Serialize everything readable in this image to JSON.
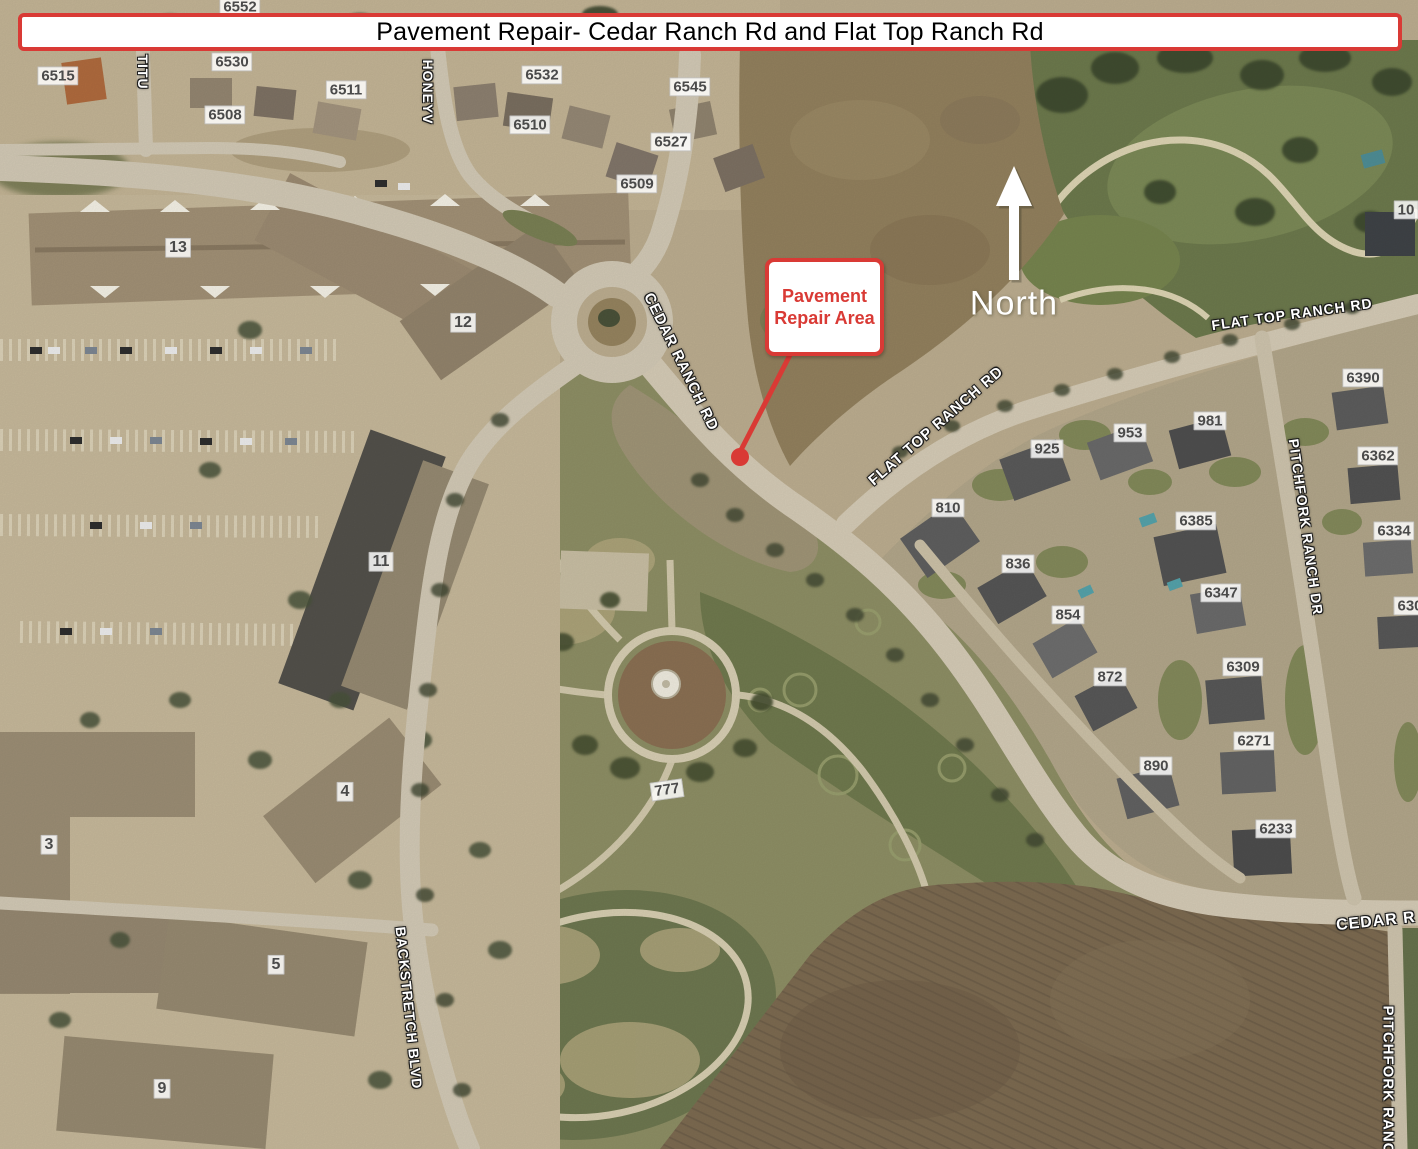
{
  "banner": {
    "title": "Pavement Repair- Cedar Ranch Rd and Flat Top Ranch Rd"
  },
  "callout": {
    "line1": "Pavement",
    "line2": "Repair Area"
  },
  "north_label": "North",
  "colors": {
    "annotation_red": "#d93a35",
    "street_label_text": "#ffffff",
    "lot_label_text": "#4a4a4a"
  },
  "street_labels": [
    {
      "text": "TITU",
      "x": 143,
      "y": 72,
      "rot": 90,
      "size": 14
    },
    {
      "text": "HONEYV",
      "x": 428,
      "y": 92,
      "rot": 90,
      "size": 14
    },
    {
      "text": "CEDAR RANCH RD",
      "x": 681,
      "y": 362,
      "rot": 64,
      "size": 15
    },
    {
      "text": "FLAT TOP RANCH RD",
      "x": 936,
      "y": 426,
      "rot": -41,
      "size": 15
    },
    {
      "text": "FLAT TOP RANCH RD",
      "x": 1292,
      "y": 314,
      "rot": -8,
      "size": 14
    },
    {
      "text": "PITCHFORK RANCH DR",
      "x": 1306,
      "y": 527,
      "rot": 82,
      "size": 14
    },
    {
      "text": "BACKSTRETCH BLVD",
      "x": 409,
      "y": 1008,
      "rot": 84,
      "size": 14
    },
    {
      "text": "CEDAR R",
      "x": 1376,
      "y": 922,
      "rot": -6,
      "size": 16
    },
    {
      "text": "PITCHFORK RANC",
      "x": 1388,
      "y": 1080,
      "rot": 90,
      "size": 15
    }
  ],
  "lot_labels": [
    {
      "text": "6552",
      "x": 240,
      "y": 7
    },
    {
      "text": "6515",
      "x": 58,
      "y": 76
    },
    {
      "text": "6530",
      "x": 232,
      "y": 62
    },
    {
      "text": "6511",
      "x": 346,
      "y": 90
    },
    {
      "text": "6508",
      "x": 225,
      "y": 115
    },
    {
      "text": "6532",
      "x": 542,
      "y": 75
    },
    {
      "text": "6510",
      "x": 530,
      "y": 125
    },
    {
      "text": "6545",
      "x": 690,
      "y": 87
    },
    {
      "text": "6527",
      "x": 671,
      "y": 142
    },
    {
      "text": "6509",
      "x": 637,
      "y": 184
    },
    {
      "text": "13",
      "x": 178,
      "y": 248,
      "size": 16
    },
    {
      "text": "12",
      "x": 463,
      "y": 323,
      "size": 16
    },
    {
      "text": "11",
      "x": 381,
      "y": 562,
      "size": 16
    },
    {
      "text": "3",
      "x": 49,
      "y": 845,
      "size": 16
    },
    {
      "text": "4",
      "x": 345,
      "y": 792,
      "size": 16
    },
    {
      "text": "5",
      "x": 276,
      "y": 965,
      "size": 16
    },
    {
      "text": "9",
      "x": 162,
      "y": 1089,
      "size": 16
    },
    {
      "text": "925",
      "x": 1047,
      "y": 449
    },
    {
      "text": "953",
      "x": 1130,
      "y": 433
    },
    {
      "text": "981",
      "x": 1210,
      "y": 421
    },
    {
      "text": "810",
      "x": 948,
      "y": 508
    },
    {
      "text": "836",
      "x": 1018,
      "y": 564
    },
    {
      "text": "854",
      "x": 1068,
      "y": 615
    },
    {
      "text": "872",
      "x": 1110,
      "y": 677
    },
    {
      "text": "890",
      "x": 1156,
      "y": 766
    },
    {
      "text": "6390",
      "x": 1363,
      "y": 378
    },
    {
      "text": "6362",
      "x": 1378,
      "y": 456
    },
    {
      "text": "6385",
      "x": 1196,
      "y": 521
    },
    {
      "text": "6334",
      "x": 1394,
      "y": 531
    },
    {
      "text": "6347",
      "x": 1221,
      "y": 593
    },
    {
      "text": "630",
      "x": 1410,
      "y": 606
    },
    {
      "text": "6309",
      "x": 1243,
      "y": 667
    },
    {
      "text": "6271",
      "x": 1254,
      "y": 741
    },
    {
      "text": "6233",
      "x": 1276,
      "y": 829
    },
    {
      "text": "777",
      "x": 667,
      "y": 790,
      "rot": -8
    },
    {
      "text": "10",
      "x": 1406,
      "y": 210
    }
  ]
}
